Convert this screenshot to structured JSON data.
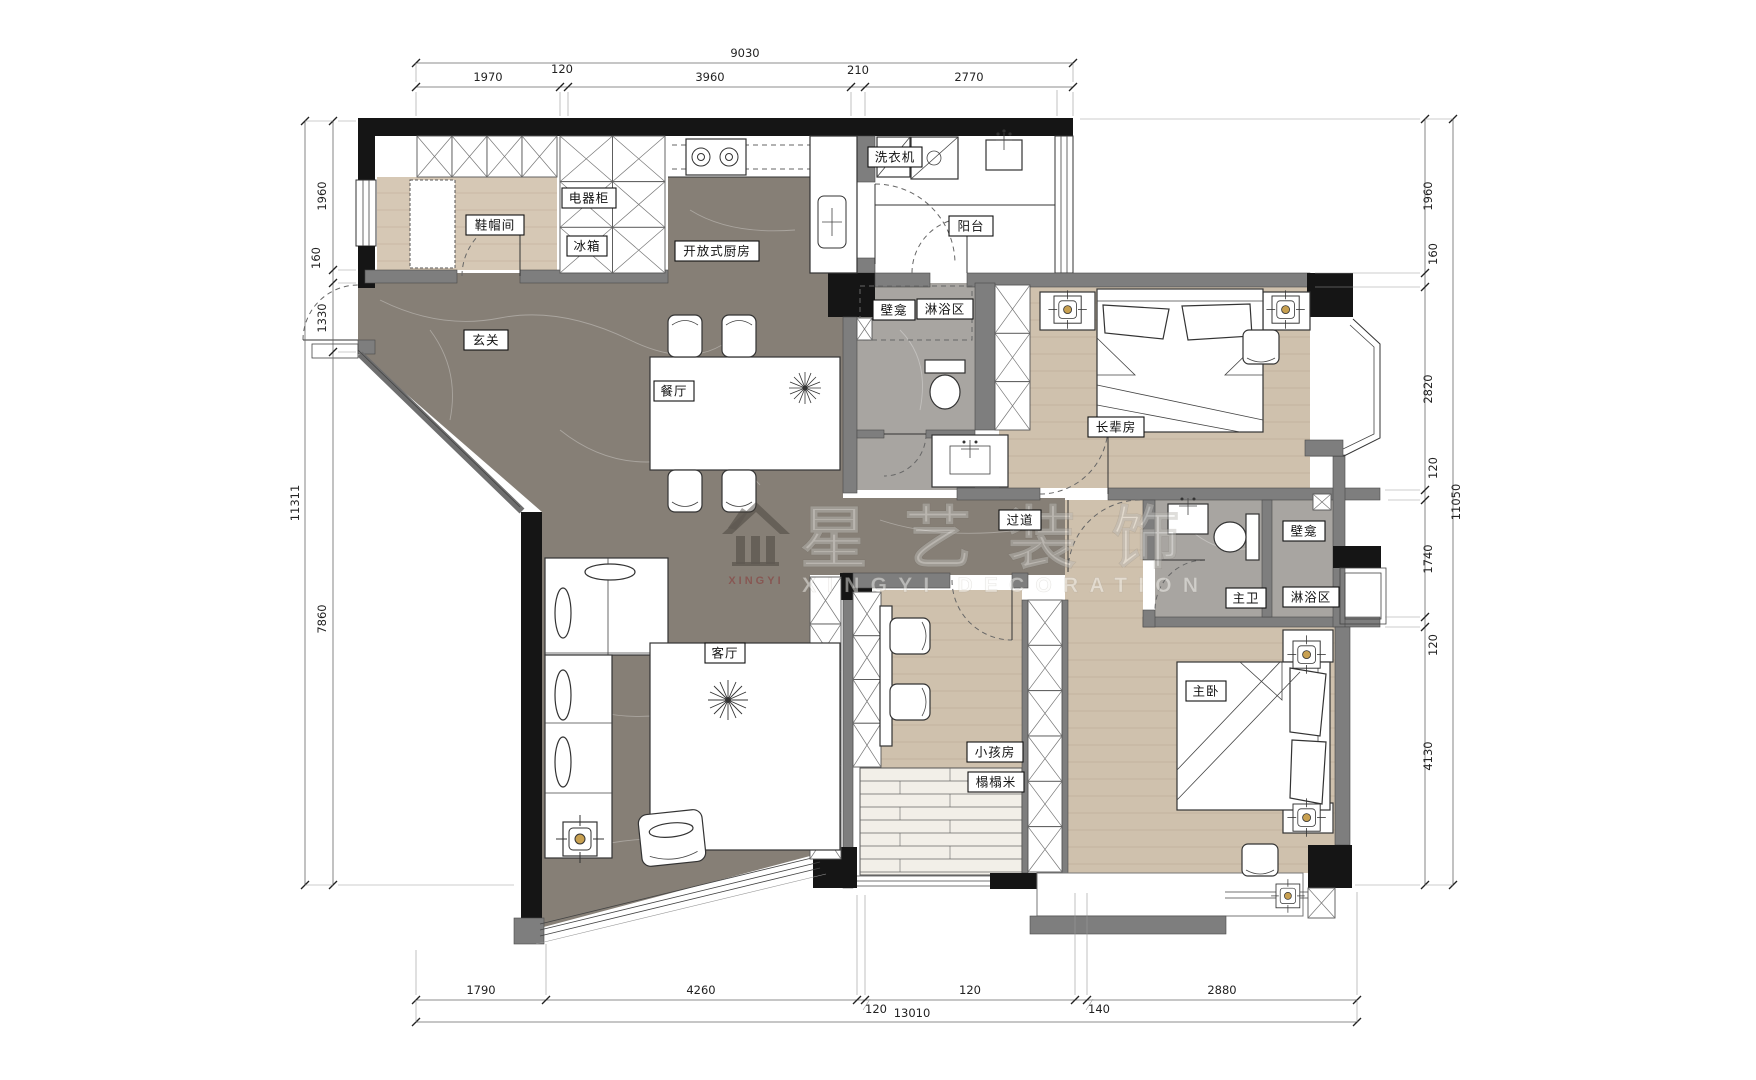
{
  "watermark": {
    "brand": "星艺装饰",
    "tagline": "XINGYI DECORATION",
    "icon_label": "XINGYI"
  },
  "rooms": {
    "entry": "玄关",
    "shoe_room": "鞋帽间",
    "appliance_cabinet": "电器柜",
    "fridge": "冰箱",
    "open_kitchen": "开放式厨房",
    "dining": "餐厅",
    "living": "客厅",
    "balcony": "阳台",
    "washer": "洗衣机",
    "niche": "壁龛",
    "shower": "淋浴区",
    "elder_room": "长辈房",
    "hallway": "过道",
    "master_bath": "主卫",
    "master_bedroom": "主卧",
    "kids_room": "小孩房",
    "tatami": "榻榻米"
  },
  "dimensions": {
    "top": {
      "total": "9030",
      "segments": [
        "1970",
        "120",
        "3960",
        "210",
        "2770"
      ]
    },
    "left": {
      "total": "11311",
      "segments": [
        "1960",
        "160",
        "1330",
        "7860"
      ]
    },
    "right": {
      "total": "11050",
      "segments": [
        "1960",
        "160",
        "2820",
        "120",
        "1740",
        "120",
        "4130"
      ]
    },
    "bottom": {
      "total": "13010",
      "segments": [
        "1790",
        "4260",
        "120",
        "2880",
        "140",
        "3820"
      ]
    }
  },
  "colors": {
    "wall": "#151515",
    "marble_floor": "#867f76",
    "wood_floor": "#cfc1ad",
    "bath_tile": "#a8a5a1",
    "lamp_accent": "#c8a050",
    "watermark_red": "#8a3030"
  }
}
